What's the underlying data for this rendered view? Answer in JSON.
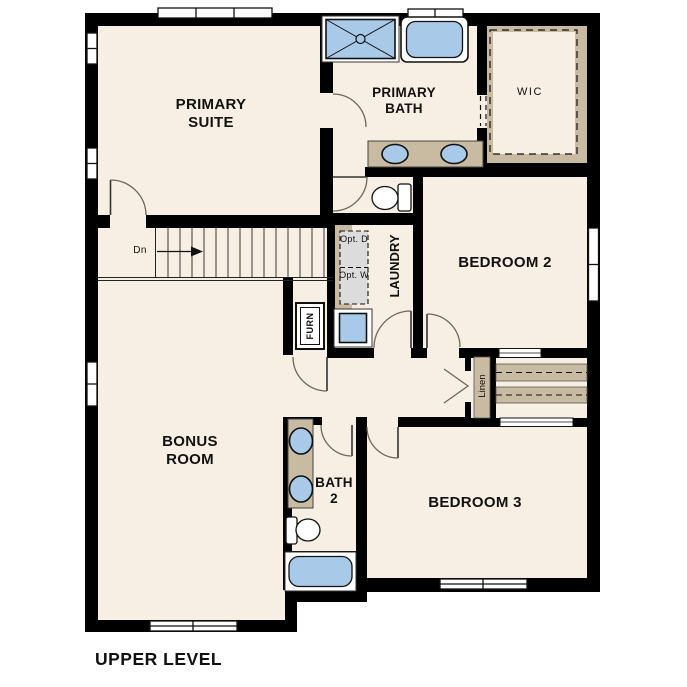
{
  "title": "UPPER LEVEL",
  "colors": {
    "floor": "#f7efe3",
    "wall": "#000000",
    "fixture_blue": "#a9c9e9",
    "counter_tan": "#c8bba1",
    "appliance_gray": "#dcdcdc"
  },
  "rooms": {
    "primary_suite": {
      "label": "PRIMARY SUITE"
    },
    "primary_bath": {
      "label": "PRIMARY BATH"
    },
    "wic": {
      "label": "WIC"
    },
    "bedroom2": {
      "label": "BEDROOM 2"
    },
    "bedroom3": {
      "label": "BEDROOM 3"
    },
    "bonus_room": {
      "label": "BONUS ROOM"
    },
    "bath2": {
      "label": "BATH 2"
    },
    "laundry": {
      "label": "LAUNDRY"
    },
    "linen": {
      "label": "Linen"
    },
    "furnace": {
      "label": "FURN"
    }
  },
  "annotations": {
    "stair_direction": "Dn",
    "optional_dryer": "Opt. D",
    "optional_washer": "Opt. W"
  }
}
